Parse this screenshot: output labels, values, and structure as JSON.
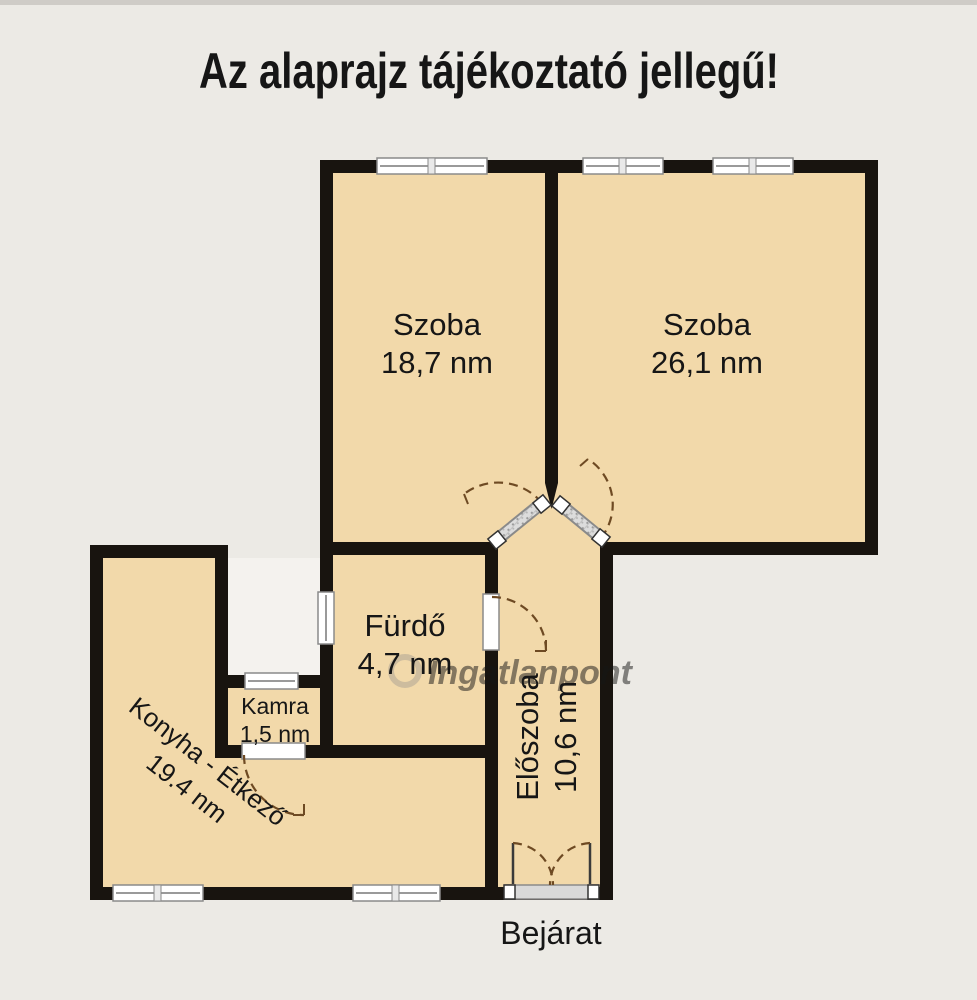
{
  "title": "Az alaprajz tájékoztató jellegű!",
  "watermark": {
    "brand": "Ingatlanpont"
  },
  "plan": {
    "rooms": [
      {
        "id": "szoba-1",
        "name": "Szoba",
        "area": "18,7 nm"
      },
      {
        "id": "szoba-2",
        "name": "Szoba",
        "area": "26,1 nm"
      },
      {
        "id": "furdo",
        "name": "Fürdő",
        "area": "4,7 nm"
      },
      {
        "id": "kamra",
        "name": "Kamra",
        "area": "1,5 nm"
      },
      {
        "id": "konyha",
        "name": "Konyha - Étkező",
        "area": "19.4 nm"
      },
      {
        "id": "eloszoba",
        "name": "Előszoba",
        "area": "10,6 nm"
      }
    ],
    "entrance_label": "Bejárat"
  },
  "colors": {
    "room_fill": "#f2d9aa",
    "wall": "#18140f",
    "background": "#eceae5",
    "notch_background": "#f4f2ee",
    "door_arc": "#6e4a23",
    "window_fill": "#ffffff",
    "watermark": "#aaa193"
  }
}
